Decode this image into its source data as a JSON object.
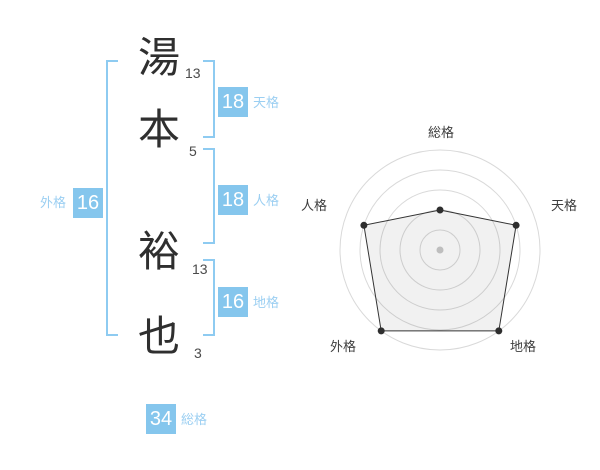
{
  "name_panel": {
    "characters": [
      {
        "char": "湯",
        "strokes": "13"
      },
      {
        "char": "本",
        "strokes": "5"
      },
      {
        "char": "裕",
        "strokes": "13"
      },
      {
        "char": "也",
        "strokes": "3"
      }
    ],
    "badges": {
      "tenkaku": {
        "value": "18",
        "label": "天格"
      },
      "jinkaku": {
        "value": "18",
        "label": "人格"
      },
      "chikaku": {
        "value": "16",
        "label": "地格"
      },
      "gaikaku": {
        "value": "16",
        "label": "外格"
      },
      "soukaku": {
        "value": "34",
        "label": "総格"
      }
    }
  },
  "chart_data": {
    "type": "radar",
    "categories": [
      "総格",
      "天格",
      "地格",
      "外格",
      "人格"
    ],
    "values": [
      40,
      80,
      100,
      100,
      80
    ],
    "max": 100,
    "grid_rings": [
      20,
      40,
      60,
      80,
      100
    ],
    "start_angle_deg": -90,
    "grid": "concentric-circles",
    "legend_position": "none"
  },
  "colors": {
    "accent_blue": "#85c6ed",
    "label_blue": "#9bcff2",
    "bracket_blue": "#8ecbf1",
    "ink": "#2f2f2f",
    "grid_gray": "#d9d9d9",
    "poly_stroke": "#333333",
    "poly_fill": "rgba(0,0,0,0.055)",
    "point_dark": "#2e2e2e",
    "center_dot": "#c9c9c9"
  }
}
